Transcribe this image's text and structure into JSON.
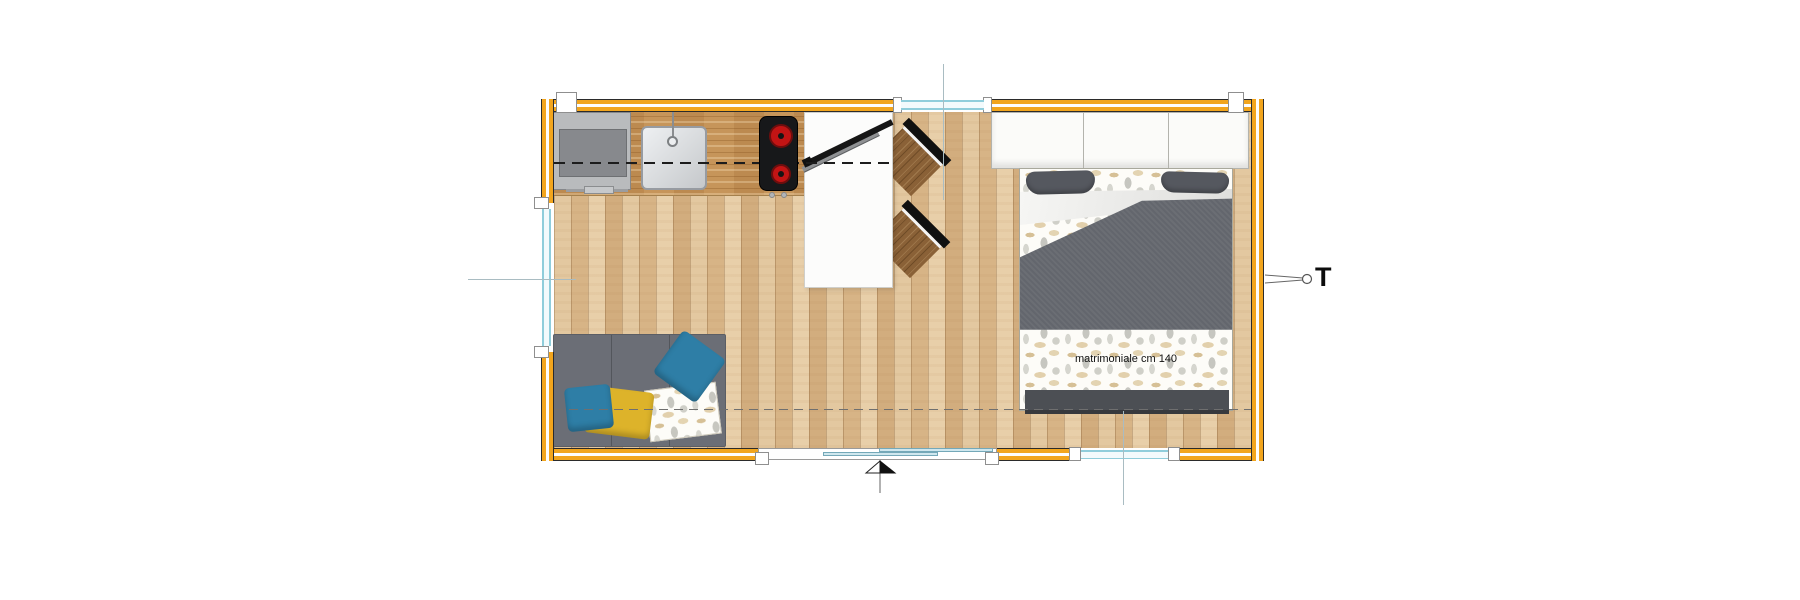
{
  "labels": {
    "bed_size": "matrimoniale cm 140",
    "thermostat": "T"
  },
  "colors": {
    "wall": "#F2A51D",
    "floor": "#DDBE94",
    "counter": "#C6955A",
    "sofa": "#6B6E76",
    "duvet": "#63666D",
    "bed_footer": "#4C4F54",
    "pillow_gray": "#55585F",
    "pillow_blue": "#2E7EA6",
    "pillow_yellow": "#DDB32A",
    "chair_wood": "#8A6137",
    "cooktop": "#17181A",
    "burner_red": "#C21414",
    "appliance": "#B9BBBD",
    "glass_line": "#8FCDDB",
    "wood_rail": "#8F9193"
  },
  "plan": {
    "type": "studio floor plan, top view",
    "items": [
      "kitchen appliance",
      "kitchen sink",
      "induction cooktop (2 burners)",
      "kitchen counter",
      "white table",
      "folding ladder",
      "chair",
      "chair",
      "wardrobe (3 doors)",
      "double bed",
      "sofa",
      "blue cushion x2",
      "yellow cushion",
      "floral throw blanket",
      "sliding entrance door with arrow",
      "window top wall",
      "window left wall",
      "window bottom wall",
      "thermostat callout T"
    ]
  }
}
